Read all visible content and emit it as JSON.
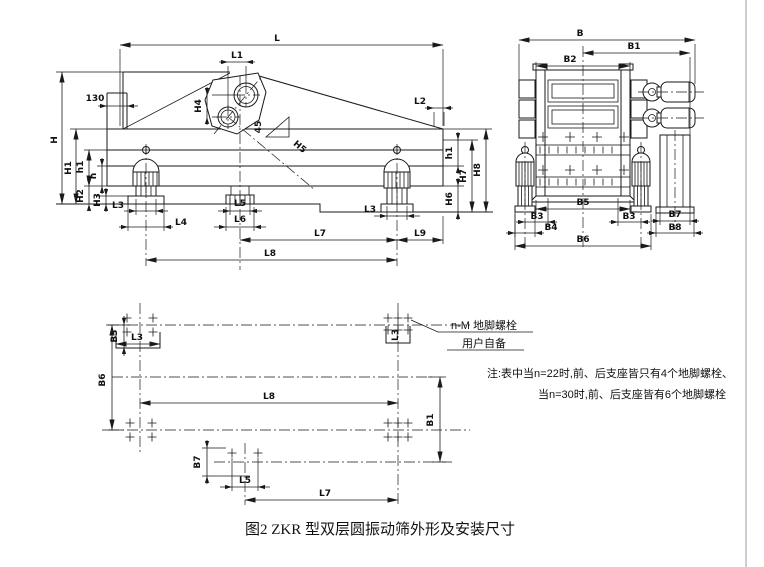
{
  "figure": {
    "caption": "图2 ZKR 型双层圆振动筛外形及安装尺寸",
    "note_line1": "注:表中当n=22时,前、后支座皆只有4个地脚螺栓、",
    "note_line2": "当n=30时,前、后支座皆有6个地脚螺栓",
    "callout_line1": "n-M 地脚螺栓",
    "callout_line2": "用户自备"
  },
  "side": {
    "L": "L",
    "L1": "L1",
    "d130": "130",
    "L2": "L2",
    "H": "H",
    "H1": "H1",
    "H2": "H2",
    "H3": "H3",
    "H4": "H4",
    "H5": "H5",
    "h": "h",
    "h1": "h1",
    "H6": "H6",
    "H7": "H7",
    "H8": "H8",
    "L3": "L3",
    "L4": "L4",
    "L5": "L5",
    "L6": "L6",
    "L7": "L7",
    "L8": "L8",
    "L9": "L9",
    "angle": "45"
  },
  "end": {
    "B": "B",
    "B1": "B1",
    "B2": "B2",
    "B3": "B3",
    "B4": "B4",
    "B5": "B5",
    "B6": "B6",
    "B7": "B7",
    "B8": "B8"
  },
  "plan": {
    "B1": "B1",
    "B3": "B3",
    "B6": "B6",
    "B7": "B7",
    "L3": "L3",
    "L5": "L5",
    "L7": "L7",
    "L8": "L8"
  }
}
